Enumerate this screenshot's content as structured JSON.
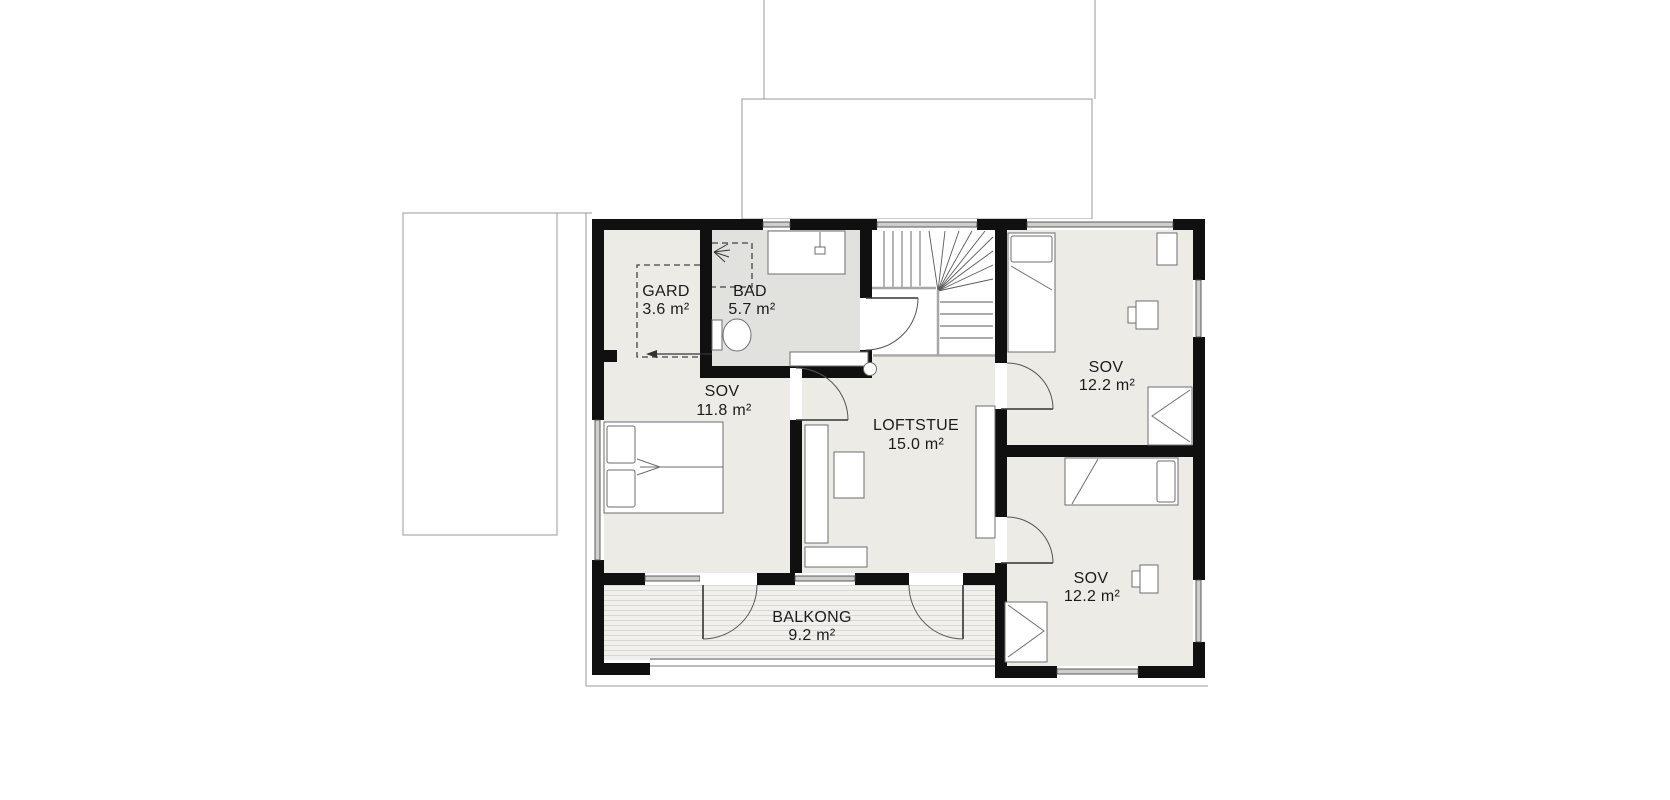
{
  "plan": {
    "title": "Upper floor plan",
    "rooms": [
      {
        "name": "GARD",
        "area": "3.6 m²"
      },
      {
        "name": "BAD",
        "area": "5.7 m²"
      },
      {
        "name": "SOV",
        "area": "11.8 m²"
      },
      {
        "name": "LOFTSTUE",
        "area": "15.0 m²"
      },
      {
        "name": "SOV",
        "area": "12.2 m²"
      },
      {
        "name": "SOV",
        "area": "12.2 m²"
      },
      {
        "name": "BALKONG",
        "area": "9.2 m²"
      }
    ],
    "colors": {
      "wall": "#101010",
      "room_fill": "#ecebe6",
      "bath_fill": "#e1e1de",
      "outline": "#9a9a9a",
      "background": "#ffffff"
    }
  }
}
